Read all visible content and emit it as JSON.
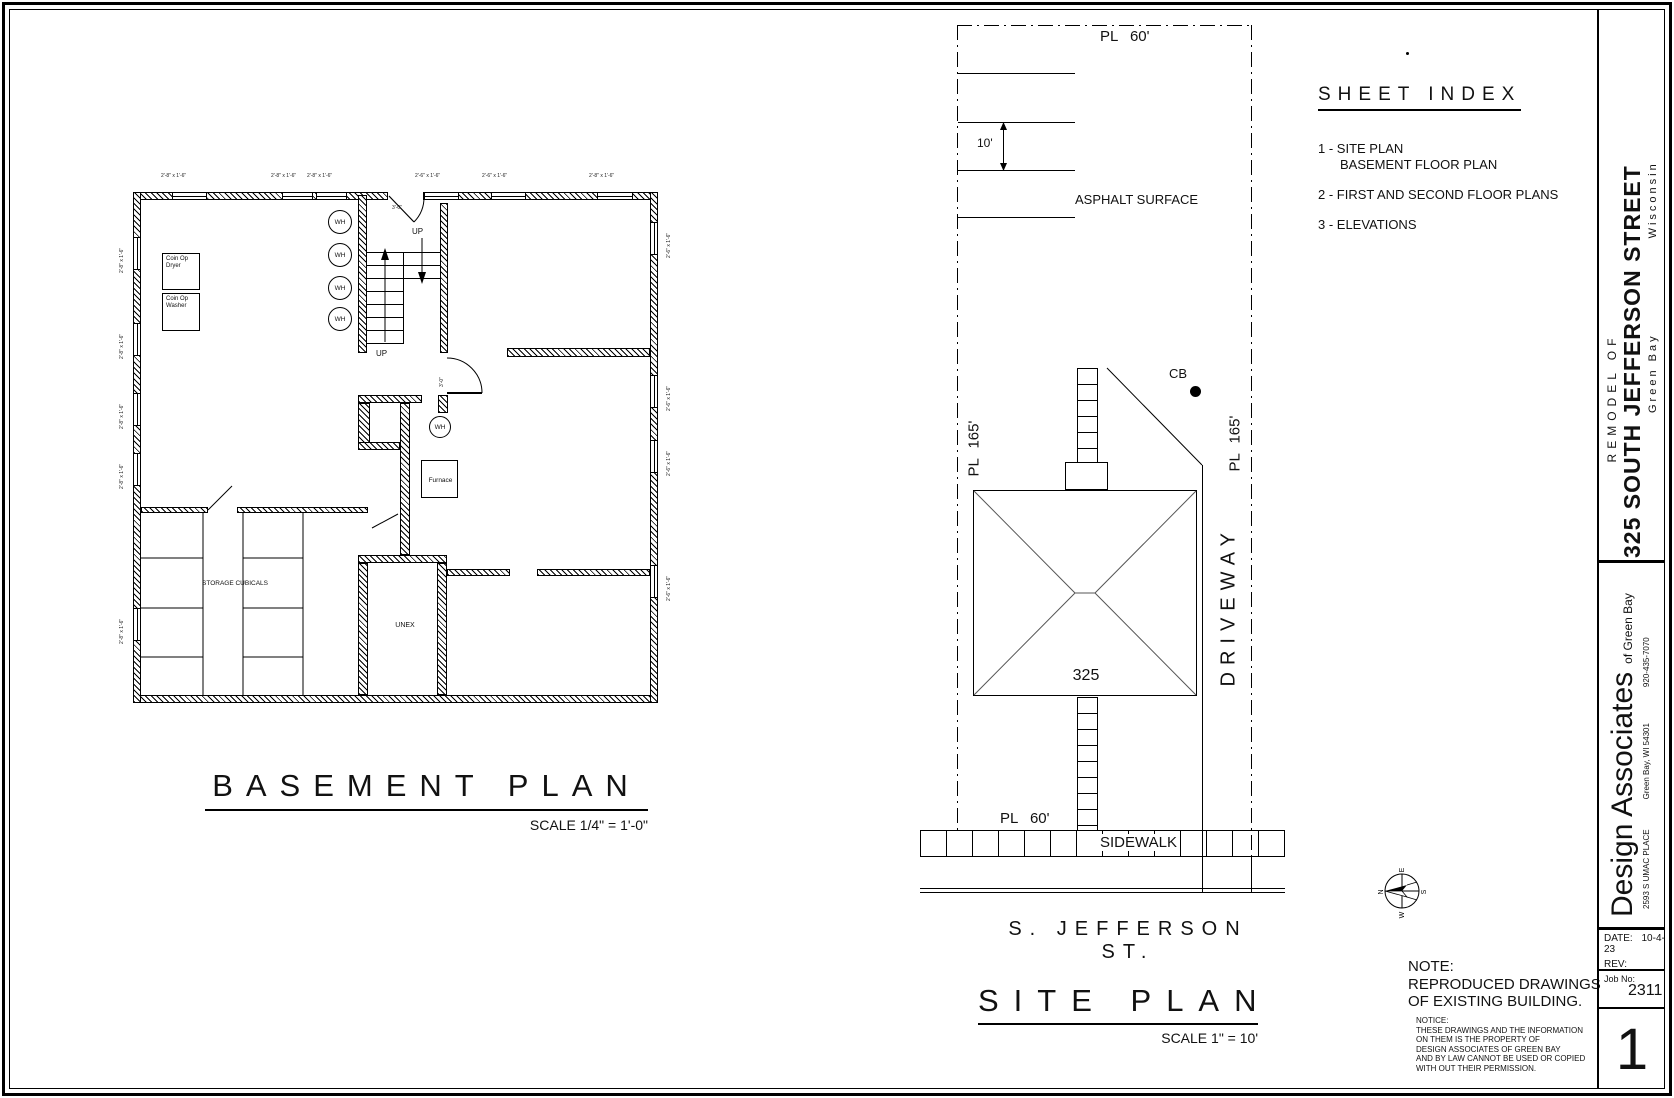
{
  "titleblock": {
    "remodel_of": "REMODEL OF",
    "project": "325 SOUTH  JEFFERSON  STREET",
    "city": "Green Bay",
    "state": "Wisconsin",
    "firm": "Design Associates",
    "firm_sub": "of  Green Bay",
    "address": "2593 S UMAC PLACE",
    "city_state_zip": "Green Bay, WI  54301",
    "phone": "920-435-7070",
    "date_label": "DATE:",
    "date_value": "10-4-23",
    "rev_label": "REV:",
    "job_label": "Job No:",
    "job_value": "2311",
    "sheet_number": "1"
  },
  "sheet_index": {
    "title": "SHEET INDEX",
    "item1_line1": "1 - SITE PLAN",
    "item1_line2": "BASEMENT FLOOR PLAN",
    "item2": "2 - FIRST AND SECOND FLOOR PLANS",
    "item3": "3 - ELEVATIONS"
  },
  "note": {
    "head": "NOTE:",
    "line1": "REPRODUCED DRAWINGS",
    "line2": "OF EXISTING BUILDING.",
    "notice_head": "NOTICE:",
    "notice_lines": [
      "THESE DRAWINGS AND THE INFORMATION",
      "ON THEM IS THE PROPERTY OF",
      "DESIGN ASSOCIATES OF GREEN BAY",
      "AND BY LAW CANNOT BE USED OR COPIED",
      "WITH OUT THEIR PERMISSION."
    ]
  },
  "compass": {
    "n": "N",
    "s": "S",
    "e": "E",
    "w": "W"
  },
  "site": {
    "title": "SITE PLAN",
    "scale": "SCALE  1\" = 10'",
    "street": "S.  JEFFERSON  ST.",
    "pl_top": "PL  60'",
    "pl_bottom": "PL  60'",
    "pl_left": "PL  165'",
    "pl_right": "PL  165'",
    "dim10": "10'",
    "asphalt": "ASPHALT SURFACE",
    "cb": "CB",
    "driveway": "DRIVEWAY",
    "sidewalk": "SIDEWALK",
    "building_no": "325"
  },
  "basement": {
    "title": "BASEMENT  PLAN",
    "scale": "SCALE 1/4\" = 1'-0\"",
    "up": "UP",
    "wh": "WH",
    "dryer_line1": "Coin Op",
    "dryer_line2": "Dryer",
    "washer_line1": "Coin Op",
    "washer_line2": "Washer",
    "furnace": "Furnace",
    "storage": "STORAGE CUBICALS",
    "unex": "UNEX",
    "door_dim": "3'-0\"",
    "win_a": "2'-8\" x 1'-6\"",
    "win_b": "2'-6\" x 1'-6\""
  }
}
